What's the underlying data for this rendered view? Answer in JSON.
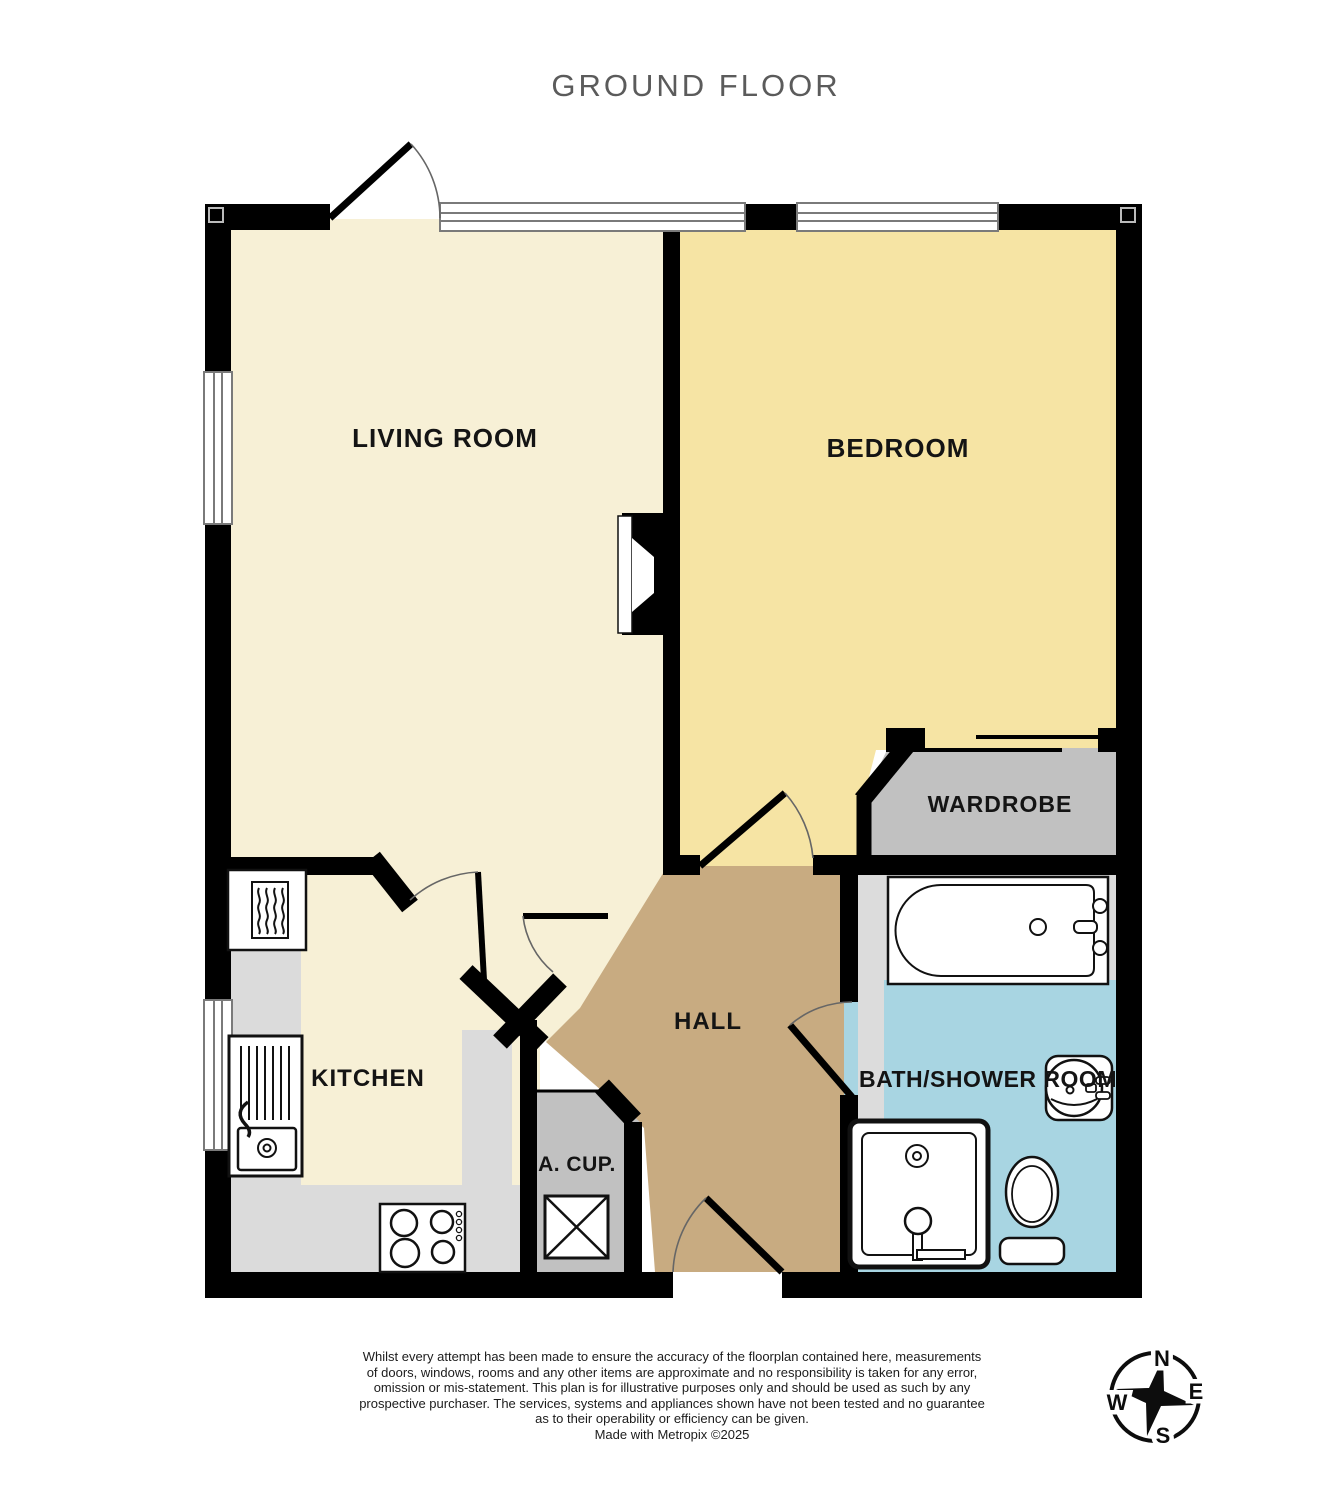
{
  "title": "GROUND FLOOR",
  "rooms": {
    "living_room": {
      "label": "LIVING ROOM"
    },
    "bedroom": {
      "label": "BEDROOM"
    },
    "wardrobe": {
      "label": "WARDROBE"
    },
    "kitchen": {
      "label": "KITCHEN"
    },
    "hall": {
      "label": "HALL"
    },
    "airing_cupboard": {
      "label": "A. CUP."
    },
    "bath_shower_room": {
      "label": "BATH/SHOWER ROOM"
    }
  },
  "icons": {
    "bathtub": "bathtub outline with taps",
    "washbasin": "round basin with tap",
    "toilet": "toilet bowl with base",
    "shower": "square shower tray with head",
    "kitchen_sink": "sink with drainer and tap",
    "hob": "4-ring hob with control dots",
    "radiator": "boxed radiator squiggle",
    "hot_water_cylinder": "crossed box",
    "fireplace": "splayed chimney recess",
    "compass": "4-point star rose"
  },
  "compass": {
    "n": "N",
    "e": "E",
    "s": "S",
    "w": "W"
  },
  "disclaimer": {
    "lines": [
      "Whilst every attempt has been made to ensure the accuracy of the floorplan contained here, measurements",
      "of doors, windows, rooms and any other items are approximate and no responsibility is taken for any error,",
      "omission or mis-statement. This plan is for illustrative purposes only and should be used as such by any",
      "prospective purchaser. The services, systems and appliances shown have not been tested and no guarantee",
      "as to their operability or efficiency can be given."
    ],
    "credit": "Made with Metropix ©2025"
  },
  "colors": {
    "living": "#f7f0d6",
    "bedroom": "#f6e4a4",
    "hall": "#c8ab81",
    "cupboard": "#c1c1c1",
    "counter": "#dbdbdb",
    "bath_floor": "#a8d5e2",
    "bath_upper": "#dcdcdc",
    "wall": "#000000",
    "window_frame": "#7a7a7a",
    "door_arc": "#666666",
    "title": "#5b5b5b"
  }
}
